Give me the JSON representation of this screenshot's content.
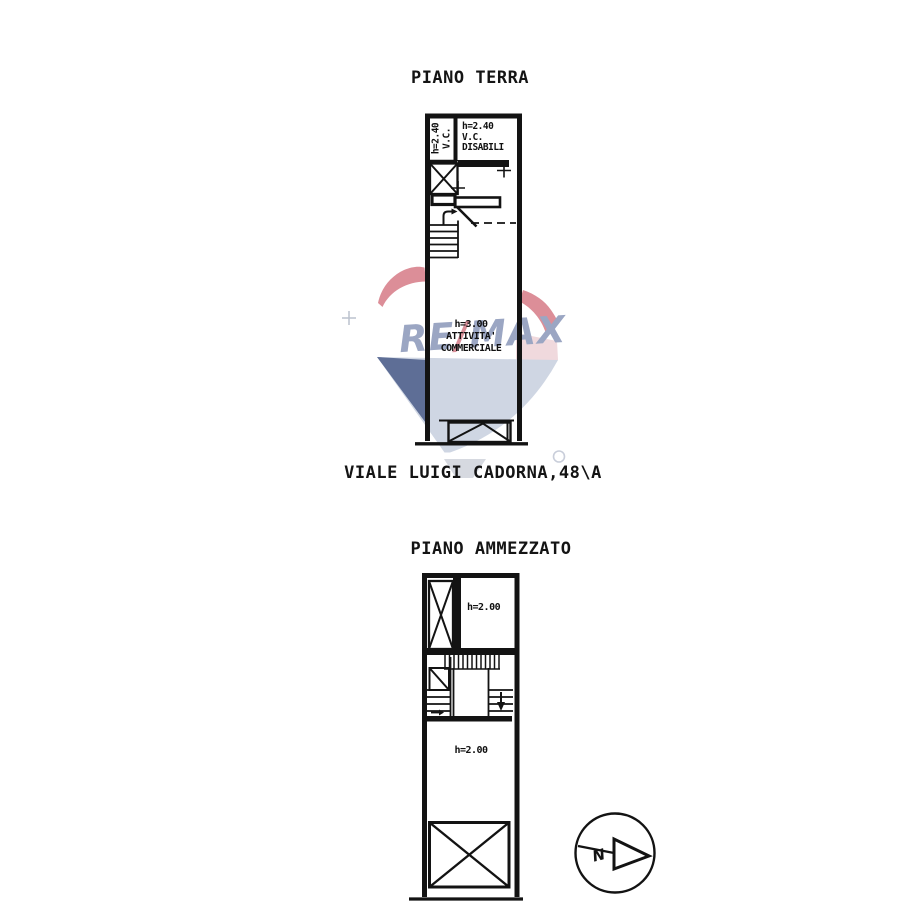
{
  "titles": {
    "ground_floor": "PIANO TERRA",
    "address": "VIALE LUIGI CADORNA,48\\A",
    "mezzanine": "PIANO AMMEZZATO"
  },
  "ground_floor_plan": {
    "wc_label_rotated": [
      "h=2.40",
      "V.C."
    ],
    "wc_disabili_label": [
      "h=2.40",
      "V.C.",
      "DISABILI"
    ],
    "main_room_label": [
      "h=3.00",
      "ATTIVITA'",
      "COMMERCIALE"
    ]
  },
  "mezzanine_plan": {
    "upper_room_label": "h=2.00",
    "main_room_label": "h=2.00"
  },
  "watermark": {
    "brand_left": "RE",
    "brand_slash": "/",
    "brand_right": "MAX",
    "colors": {
      "red": "#DC8E98",
      "pink_light": "#F0D9DD",
      "blue_dark": "#5E6E96",
      "blue_light": "#CFD6E3",
      "letters": "#9BA6C3",
      "slash": "#D98F99",
      "gray_light": "#D6D9E0"
    }
  },
  "compass": {
    "north_label": "N"
  },
  "drawing": {
    "line_color": "#131313"
  }
}
